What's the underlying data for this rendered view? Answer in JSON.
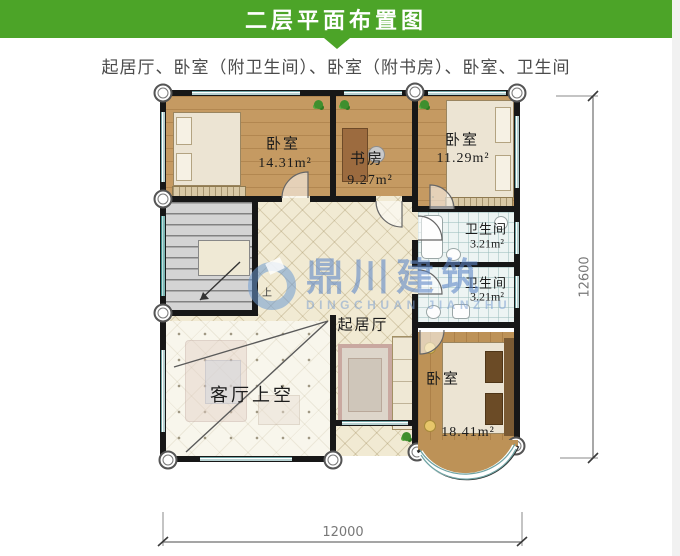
{
  "header": {
    "title": "二层平面布置图"
  },
  "subtitle": "起居厅、卧室（附卫生间）、卧室（附书房）、卧室、卫生间",
  "watermark": {
    "cn": "鼎川建筑",
    "en": "DINGCHUAN JIANZHU"
  },
  "rooms": [
    {
      "label": "卧室",
      "area": "14.31m²"
    },
    {
      "label": "书房",
      "area": "9.27m²"
    },
    {
      "label": "卧室",
      "area": "11.29m²"
    },
    {
      "label": "卫生间",
      "area": "3.21m²"
    },
    {
      "label": "卫生间",
      "area": "3.21m²"
    },
    {
      "label": "起居厅"
    },
    {
      "label": "客厅上空"
    },
    {
      "label": "卧室",
      "area": "18.41m²"
    }
  ],
  "stairs": {
    "up_label": "上"
  },
  "dimensions": {
    "width": "12000",
    "height": "12600"
  },
  "colors": {
    "accent_green": "#4ca428",
    "watermark_blue": "#5f87c8"
  }
}
